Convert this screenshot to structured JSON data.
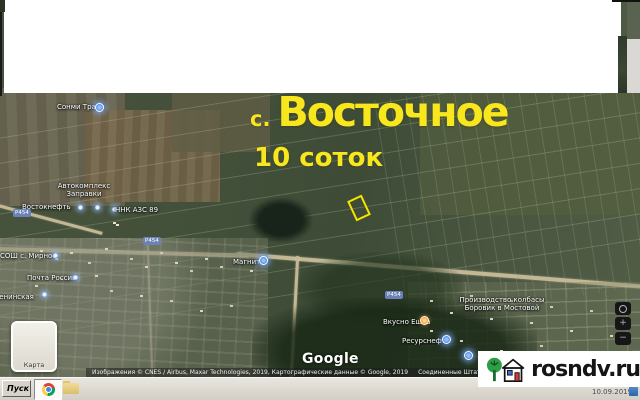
{
  "overlay": {
    "title_prefix": "с.",
    "title": "Восточное",
    "subtitle": "10 соток"
  },
  "map": {
    "labels": [
      {
        "id": "sonmi-trans",
        "line1": "Сонми Транс"
      },
      {
        "id": "avtokompleks",
        "line1": "Автокомплекс",
        "line2": "Заправки"
      },
      {
        "id": "vostokneft",
        "line1": "Востокнефть"
      },
      {
        "id": "nnk-azs",
        "line1": "ННК АЗС 89"
      },
      {
        "id": "sosh-mirnoe",
        "line1": "СОШ с. Мирное"
      },
      {
        "id": "pochta",
        "line1": "Почта России"
      },
      {
        "id": "leninskaya",
        "line1": "Ленинская"
      },
      {
        "id": "magnit",
        "line1": "Магнит"
      },
      {
        "id": "proizvodstvo",
        "line1": "Производство колбасы",
        "line2": "Боровик в Мостовой"
      },
      {
        "id": "vkusno-eshka",
        "line1": "Вкусно Ешка"
      },
      {
        "id": "resursneft",
        "line1": "Ресурснефть"
      }
    ],
    "road_badge": "Р454",
    "map_type_label": "Карта",
    "logo": "Google",
    "controls": {
      "zoom_in": "+",
      "zoom_out": "−"
    },
    "attribution": {
      "imagery": "Изображения © CNES / Airbus, Maxar Technologies, 2019, Картографические данные © Google, 2019",
      "region": "Соединенные Штаты",
      "mode": "3D-режим недоступен",
      "terms": "Условия использования"
    }
  },
  "watermark": {
    "text": "rosndv.ru"
  },
  "taskbar": {
    "start_label": "Пуск",
    "date": "10.09.2019"
  },
  "colors": {
    "accent_yellow": "#f8e71c",
    "parcel_outline": "#f5e400",
    "marker_blue": "#3f7de0",
    "marker_orange": "#f08a1d",
    "watermark_bg": "#ffffff",
    "taskbar_gray": "#d7d3cb"
  }
}
